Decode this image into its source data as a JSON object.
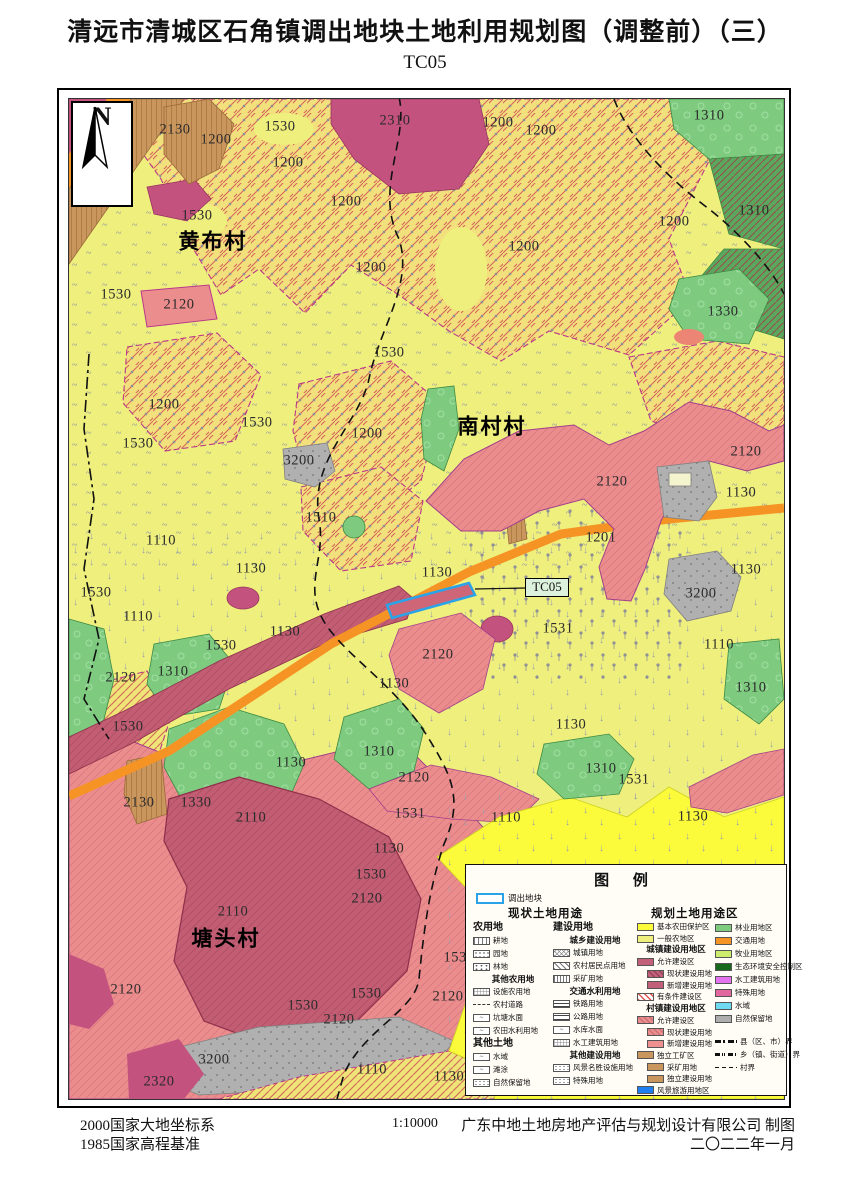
{
  "page": {
    "title": "清远市清城区石角镇调出地块土地利用规划图（调整前）（三）",
    "subtitle": "TC05"
  },
  "map": {
    "north_label": "N",
    "callout": {
      "label": "TC05"
    },
    "villages": [
      {
        "n": "黄布村",
        "x": 144,
        "y": 143
      },
      {
        "n": "南村村",
        "x": 423,
        "y": 328
      },
      {
        "n": "塘头村",
        "x": 157,
        "y": 840
      }
    ],
    "labels": [
      {
        "t": "2130",
        "x": 106,
        "y": 32
      },
      {
        "t": "1530",
        "x": 211,
        "y": 29
      },
      {
        "t": "2310",
        "x": 326,
        "y": 23
      },
      {
        "t": "1200",
        "x": 429,
        "y": 25
      },
      {
        "t": "1200",
        "x": 472,
        "y": 33
      },
      {
        "t": "1310",
        "x": 640,
        "y": 18
      },
      {
        "t": "1200",
        "x": 147,
        "y": 42
      },
      {
        "t": "1200",
        "x": 219,
        "y": 65
      },
      {
        "t": "1530",
        "x": 128,
        "y": 118
      },
      {
        "t": "1200",
        "x": 277,
        "y": 104
      },
      {
        "t": "1200",
        "x": 455,
        "y": 149
      },
      {
        "t": "1200",
        "x": 605,
        "y": 124
      },
      {
        "t": "1310",
        "x": 685,
        "y": 113
      },
      {
        "t": "1530",
        "x": 47,
        "y": 197
      },
      {
        "t": "2120",
        "x": 110,
        "y": 207
      },
      {
        "t": "1200",
        "x": 302,
        "y": 170
      },
      {
        "t": "1330",
        "x": 654,
        "y": 214
      },
      {
        "t": "1530",
        "x": 320,
        "y": 255
      },
      {
        "t": "1200",
        "x": 95,
        "y": 307
      },
      {
        "t": "1530",
        "x": 69,
        "y": 346
      },
      {
        "t": "1530",
        "x": 188,
        "y": 325
      },
      {
        "t": "1200",
        "x": 298,
        "y": 336
      },
      {
        "t": "3200",
        "x": 230,
        "y": 363
      },
      {
        "t": "2120",
        "x": 677,
        "y": 354
      },
      {
        "t": "2120",
        "x": 543,
        "y": 384
      },
      {
        "t": "1130",
        "x": 672,
        "y": 395
      },
      {
        "t": "1510",
        "x": 252,
        "y": 420
      },
      {
        "t": "1110",
        "x": 92,
        "y": 443
      },
      {
        "t": "1201",
        "x": 532,
        "y": 440
      },
      {
        "t": "1130",
        "x": 368,
        "y": 475
      },
      {
        "t": "1130",
        "x": 677,
        "y": 472
      },
      {
        "t": "3200",
        "x": 632,
        "y": 496
      },
      {
        "t": "1530",
        "x": 27,
        "y": 495
      },
      {
        "t": "1130",
        "x": 182,
        "y": 471
      },
      {
        "t": "1110",
        "x": 69,
        "y": 519
      },
      {
        "t": "1531",
        "x": 489,
        "y": 531
      },
      {
        "t": "1130",
        "x": 216,
        "y": 534
      },
      {
        "t": "1110",
        "x": 650,
        "y": 547
      },
      {
        "t": "2120",
        "x": 369,
        "y": 557
      },
      {
        "t": "1310",
        "x": 104,
        "y": 574
      },
      {
        "t": "2120",
        "x": 52,
        "y": 580
      },
      {
        "t": "1130",
        "x": 325,
        "y": 586
      },
      {
        "t": "1310",
        "x": 682,
        "y": 590
      },
      {
        "t": "1530",
        "x": 152,
        "y": 548
      },
      {
        "t": "1530",
        "x": 59,
        "y": 629
      },
      {
        "t": "1130",
        "x": 222,
        "y": 665
      },
      {
        "t": "1310",
        "x": 310,
        "y": 654
      },
      {
        "t": "2120",
        "x": 345,
        "y": 680
      },
      {
        "t": "1130",
        "x": 502,
        "y": 627
      },
      {
        "t": "1310",
        "x": 532,
        "y": 671
      },
      {
        "t": "1531",
        "x": 565,
        "y": 682
      },
      {
        "t": "1110",
        "x": 437,
        "y": 720
      },
      {
        "t": "1130",
        "x": 624,
        "y": 719
      },
      {
        "t": "2130",
        "x": 70,
        "y": 705
      },
      {
        "t": "1330",
        "x": 127,
        "y": 705
      },
      {
        "t": "2110",
        "x": 182,
        "y": 720
      },
      {
        "t": "1531",
        "x": 341,
        "y": 716
      },
      {
        "t": "1130",
        "x": 320,
        "y": 751
      },
      {
        "t": "1530",
        "x": 302,
        "y": 777
      },
      {
        "t": "2110",
        "x": 164,
        "y": 814
      },
      {
        "t": "2120",
        "x": 298,
        "y": 801
      },
      {
        "t": "2120",
        "x": 57,
        "y": 892
      },
      {
        "t": "1530",
        "x": 297,
        "y": 896
      },
      {
        "t": "1530",
        "x": 390,
        "y": 860
      },
      {
        "t": "1530",
        "x": 234,
        "y": 908
      },
      {
        "t": "2120",
        "x": 379,
        "y": 899
      },
      {
        "t": "2120",
        "x": 270,
        "y": 922
      },
      {
        "t": "3200",
        "x": 145,
        "y": 962
      },
      {
        "t": "2320",
        "x": 90,
        "y": 984
      },
      {
        "t": "1110",
        "x": 303,
        "y": 972
      },
      {
        "t": "1130",
        "x": 380,
        "y": 979
      }
    ]
  },
  "legend": {
    "title": "图  例",
    "parcel_label": "调出地块",
    "col_headers": [
      "现状土地用途",
      "规划土地用途区"
    ],
    "columns": [
      [
        {
          "h": "农用地"
        },
        {
          "t": "耕地",
          "s": "plow"
        },
        {
          "t": "园地",
          "s": "orchard"
        },
        {
          "t": "林地",
          "s": "forest"
        },
        {
          "sh": "其他农用地"
        },
        {
          "t": "设施农用地",
          "s": "facility"
        },
        {
          "t": "农村道路",
          "s": "dashline"
        },
        {
          "t": "坑塘水面",
          "g": "~"
        },
        {
          "t": "农田水利用地",
          "g": "~"
        },
        {
          "h": "其他土地"
        },
        {
          "t": "水域",
          "g": "~"
        },
        {
          "t": "滩涂",
          "g": "~"
        },
        {
          "t": "自然保留地",
          "s": "dotgrid"
        }
      ],
      [
        {
          "h": "建设用地"
        },
        {
          "sh": "城乡建设用地"
        },
        {
          "t": "城镇用地",
          "s": "urban"
        },
        {
          "t": "农村居民点用地",
          "s": "ruralres"
        },
        {
          "t": "采矿用地",
          "s": "mining"
        },
        {
          "sh": "交通水利用地"
        },
        {
          "t": "铁路用地",
          "s": "rail"
        },
        {
          "t": "公路用地",
          "s": "hwy"
        },
        {
          "t": "水库水面",
          "g": "~"
        },
        {
          "t": "水工建筑用地",
          "s": "facility"
        },
        {
          "sh": "其他建设用地"
        },
        {
          "t": "风景名胜设施用地",
          "s": "dotgrid"
        },
        {
          "t": "特殊用地",
          "s": "dotgrid"
        }
      ],
      [
        {
          "t": "基本农田保护区",
          "c": "#fbfb3b"
        },
        {
          "t": "一般农地区",
          "c": "#efef7d"
        },
        {
          "sh": "城镇建设用地区"
        },
        {
          "t": "允许建设区",
          "c": "#c2607a"
        },
        {
          "t": "现状建设用地",
          "s": "hatchdark",
          "i": 1
        },
        {
          "t": "新增建设用地",
          "c": "#c2607a",
          "i": 1
        },
        {
          "t": "有条件建设区",
          "s": "cond"
        },
        {
          "sh": "村镇建设用地区"
        },
        {
          "t": "允许建设区",
          "s": "hatchpink"
        },
        {
          "t": "现状建设用地",
          "s": "hatchpink",
          "i": 1
        },
        {
          "t": "新增建设用地",
          "c": "#ee9090",
          "i": 1
        },
        {
          "t": "独立工矿区",
          "c": "#c9965e"
        },
        {
          "t": "采矿用地",
          "c": "#c9965e",
          "i": 1
        },
        {
          "t": "独立建设用地",
          "c": "#c9965e",
          "i": 1
        },
        {
          "t": "风景旅游用地区",
          "c": "#1f7ff0"
        }
      ],
      [
        {
          "t": "林业用地区",
          "c": "#7ecb80"
        },
        {
          "t": "交通用地",
          "c": "#f59425"
        },
        {
          "t": "牧业用地区",
          "c": "#cdec6e"
        },
        {
          "t": "生态环境安全控制区",
          "c": "#17691c"
        },
        {
          "t": "水工建筑用地",
          "c": "#e473ef"
        },
        {
          "t": "特殊用地",
          "c": "#e2679f"
        },
        {
          "t": "水域",
          "c": "#6fd9f2"
        },
        {
          "t": "自然保留地",
          "c": "#aeaeae"
        },
        {
          "gap": 1
        },
        {
          "t": "县（区、市）界",
          "s": "county"
        },
        {
          "t": "乡（镇、街道）界",
          "s": "town"
        },
        {
          "t": "村界",
          "s": "vill"
        }
      ]
    ]
  },
  "footer": {
    "datum1": "2000国家大地坐标系",
    "datum2": "1985国家高程基准",
    "scale": "1:10000",
    "maker": "广东中地土地房地产评估与规划设计有限公司  制图",
    "date": "二〇二二年一月"
  },
  "colors": {
    "base_yellow": "#efef7d",
    "prime_farmland_yellow": "#fbfb3b",
    "village_pink": "#ec8d8d",
    "existing_rose": "#c2586f",
    "magenta": "#c4527e",
    "road_orange": "#f59425",
    "forest_green": "#7ecb80",
    "reserve_gray": "#b0b0b0",
    "mining_brown": "#c9965e",
    "parcel_blue": "#2aa3e8"
  }
}
